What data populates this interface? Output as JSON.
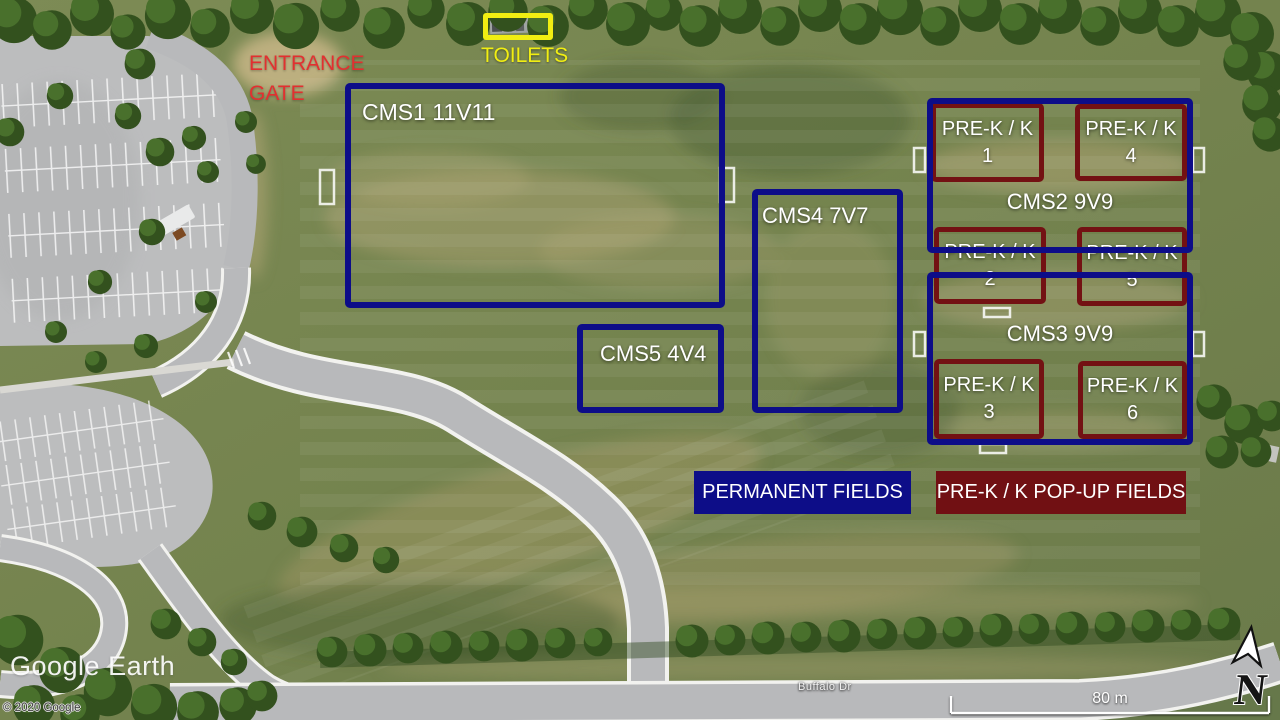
{
  "map": {
    "watermark": "Google Earth",
    "copyright": "© 2020 Google",
    "street_label": "Buffalo Dr",
    "scale_label": "80 m",
    "compass_label": "N"
  },
  "annotations": {
    "entrance_gate": {
      "line1": "ENTRANCE",
      "line2": "GATE"
    },
    "toilets": {
      "label": "TOILETS"
    }
  },
  "permanent_fields": [
    {
      "id": "cms1",
      "label": "CMS1 11V11"
    },
    {
      "id": "cms2",
      "label": "CMS2 9V9"
    },
    {
      "id": "cms3",
      "label": "CMS3 9V9"
    },
    {
      "id": "cms4",
      "label": "CMS4 7V7"
    },
    {
      "id": "cms5",
      "label": "CMS5 4V4"
    }
  ],
  "popup_fields": [
    {
      "title": "PRE-K / K",
      "number": "1"
    },
    {
      "title": "PRE-K / K",
      "number": "2"
    },
    {
      "title": "PRE-K / K",
      "number": "3"
    },
    {
      "title": "PRE-K / K",
      "number": "4"
    },
    {
      "title": "PRE-K / K",
      "number": "5"
    },
    {
      "title": "PRE-K / K",
      "number": "6"
    }
  ],
  "legend": {
    "permanent": {
      "label": "PERMANENT FIELDS",
      "color": "#0d0d88"
    },
    "popup": {
      "label": "PRE-K / K POP-UP FIELDS",
      "color": "#711013"
    }
  },
  "colors": {
    "permanent_outline": "#0d0d88",
    "popup_outline": "#731113",
    "toilets_outline": "#f1ee12",
    "entrance_text": "#e23030"
  }
}
